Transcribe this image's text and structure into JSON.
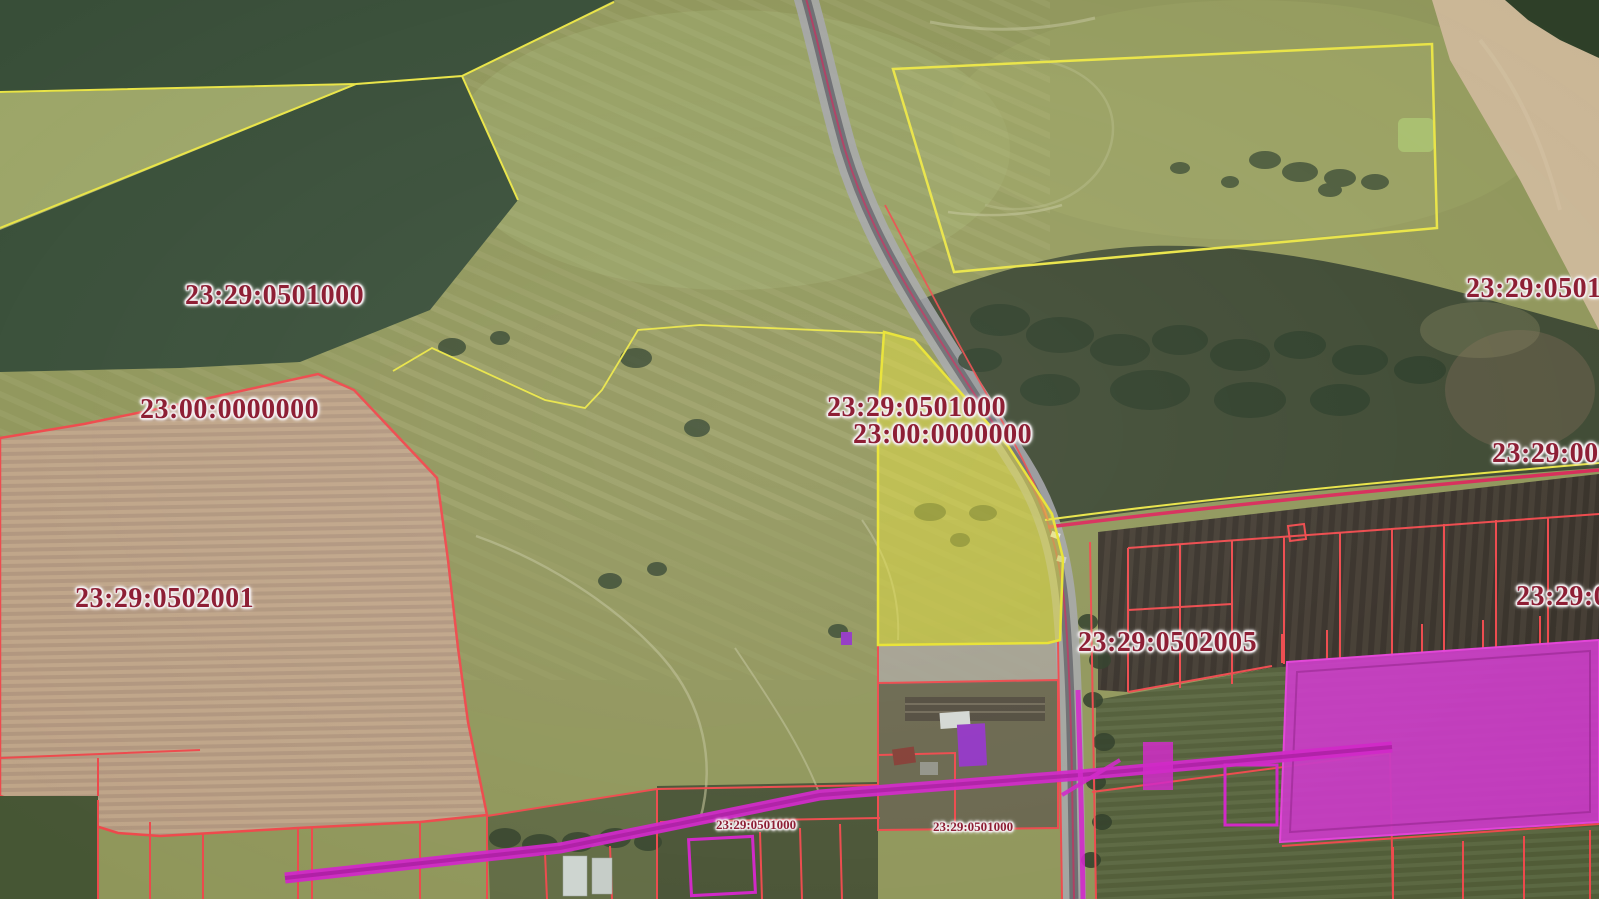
{
  "map": {
    "kind": "cadastral-satellite-map",
    "labels": [
      {
        "text": "23:29:0501000",
        "size": "large"
      },
      {
        "text": "23:00:0000000",
        "size": "large"
      },
      {
        "text": "23:29:0502001",
        "size": "large"
      },
      {
        "text": "23:29:0501000",
        "size": "large"
      },
      {
        "text": "23:00:0000000",
        "size": "large"
      },
      {
        "text": "23:29:0502005",
        "size": "large"
      },
      {
        "text": "23:29:05010",
        "size": "large",
        "truncated_at_edge": true
      },
      {
        "text": "23:29:000",
        "size": "large",
        "truncated_at_edge": true
      },
      {
        "text": "23:29:0",
        "size": "large",
        "truncated_at_edge": true
      },
      {
        "text": "23:29:0501000",
        "size": "small"
      },
      {
        "text": "23:29:0501000",
        "size": "small"
      }
    ],
    "colors": {
      "label_text": "#8e1f35",
      "label_halo": "#f4eff1",
      "parcel_red": "#ee4044",
      "parcel_yellow": "#e9e43e",
      "boundary_crimson": "#d62052",
      "selected_parcel_fill": "#e6df2e",
      "magenta_parcel_fill": "#c52fc2",
      "magenta_line": "#cf1ac6",
      "purple_building": "#8d2cc2",
      "grass": "#8b9254",
      "forest": "#2f4630",
      "plowed_field": "#bda184",
      "soil_dark": "#2e2720",
      "crop_green": "#49552f",
      "tan_field": "#c9b493",
      "road_grey": "#a2a3aa"
    }
  }
}
